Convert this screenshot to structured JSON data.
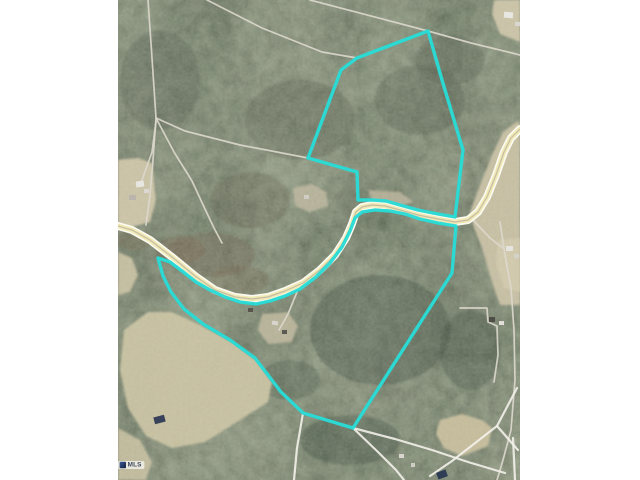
{
  "scene": {
    "width": 640,
    "height": 480,
    "background": "#ffffff"
  },
  "map": {
    "area": {
      "x": 118,
      "y": 0,
      "width": 402,
      "height": 480
    },
    "colors": {
      "forest_base": "#434a3d",
      "field_tan": "#cbc3a5",
      "road_casing": "#fbfaf0",
      "road_fill": "#f1e9b4",
      "road_centerline": "#b9b1a0",
      "parcel_line": "#ddd8cd",
      "parcel_line_bright": "#f3f1ea",
      "boundary_cyan": "#29dbd6"
    },
    "watermark": {
      "text": "MLS"
    },
    "fields": [
      {
        "name": "left-clearing",
        "color": "#cdc5a8",
        "pts": [
          [
            118,
            160
          ],
          [
            138,
            158
          ],
          [
            152,
            163
          ],
          [
            156,
            200
          ],
          [
            150,
            222
          ],
          [
            128,
            228
          ],
          [
            118,
            224
          ]
        ]
      },
      {
        "name": "left-small-field",
        "color": "#c6bfa2",
        "pts": [
          [
            118,
            252
          ],
          [
            132,
            258
          ],
          [
            138,
            275
          ],
          [
            130,
            292
          ],
          [
            118,
            295
          ]
        ]
      },
      {
        "name": "bottom-left-field",
        "color": "#c9c2a2",
        "pts": [
          [
            124,
            330
          ],
          [
            148,
            312
          ],
          [
            172,
            312
          ],
          [
            200,
            325
          ],
          [
            232,
            342
          ],
          [
            258,
            362
          ],
          [
            272,
            382
          ],
          [
            268,
            402
          ],
          [
            240,
            420
          ],
          [
            205,
            442
          ],
          [
            172,
            448
          ],
          [
            146,
            436
          ],
          [
            128,
            408
          ],
          [
            120,
            370
          ]
        ]
      },
      {
        "name": "bottom-left-strip",
        "color": "#c3bc9e",
        "pts": [
          [
            118,
            428
          ],
          [
            140,
            440
          ],
          [
            152,
            462
          ],
          [
            146,
            480
          ],
          [
            118,
            480
          ]
        ]
      },
      {
        "name": "east-road-field",
        "color": "#c8c0a4",
        "pts": [
          [
            470,
            212
          ],
          [
            480,
            185
          ],
          [
            492,
            155
          ],
          [
            503,
            132
          ],
          [
            516,
            122
          ],
          [
            520,
            122
          ],
          [
            520,
            305
          ],
          [
            500,
            305
          ],
          [
            492,
            282
          ],
          [
            482,
            248
          ],
          [
            474,
            228
          ]
        ]
      },
      {
        "name": "topright-clearing",
        "color": "#ccc4a8",
        "pts": [
          [
            494,
            0
          ],
          [
            520,
            0
          ],
          [
            520,
            42
          ],
          [
            500,
            34
          ],
          [
            492,
            14
          ]
        ]
      },
      {
        "name": "bottomright-field",
        "color": "#c7bd9c",
        "pts": [
          [
            440,
            420
          ],
          [
            462,
            414
          ],
          [
            482,
            420
          ],
          [
            492,
            428
          ],
          [
            488,
            446
          ],
          [
            462,
            456
          ],
          [
            444,
            448
          ],
          [
            436,
            434
          ]
        ]
      },
      {
        "name": "center-clearing",
        "color": "#b7b29a",
        "pts": [
          [
            293,
            188
          ],
          [
            312,
            184
          ],
          [
            326,
            192
          ],
          [
            328,
            206
          ],
          [
            310,
            212
          ],
          [
            295,
            206
          ]
        ]
      },
      {
        "name": "crest-north-clearing",
        "color": "#b3ae96",
        "pts": [
          [
            368,
            190
          ],
          [
            400,
            192
          ],
          [
            414,
            202
          ],
          [
            398,
            207
          ],
          [
            372,
            200
          ]
        ]
      },
      {
        "name": "lower-houses-clearing",
        "color": "#b9b49a",
        "pts": [
          [
            262,
            314
          ],
          [
            288,
            312
          ],
          [
            298,
            326
          ],
          [
            292,
            342
          ],
          [
            268,
            344
          ],
          [
            258,
            330
          ]
        ]
      },
      {
        "name": "east-houses-ground",
        "color": "#d0c8ab",
        "pts": [
          [
            498,
            240
          ],
          [
            520,
            238
          ],
          [
            520,
            292
          ],
          [
            504,
            288
          ],
          [
            496,
            264
          ]
        ]
      }
    ],
    "parcel_lines": [
      {
        "pts": [
          [
            148,
            0
          ],
          [
            152,
            58
          ],
          [
            156,
            118
          ]
        ]
      },
      {
        "pts": [
          [
            156,
            118
          ],
          [
            185,
            131
          ],
          [
            240,
            145
          ],
          [
            308,
            158
          ]
        ]
      },
      {
        "pts": [
          [
            156,
            118
          ],
          [
            174,
            152
          ],
          [
            192,
            181
          ],
          [
            205,
            209
          ],
          [
            214,
            228
          ],
          [
            222,
            243
          ]
        ]
      },
      {
        "pts": [
          [
            156,
            118
          ],
          [
            153,
            160
          ],
          [
            150,
            195
          ],
          [
            146,
            225
          ]
        ]
      },
      {
        "pts": [
          [
            310,
            0
          ],
          [
            428,
            31
          ],
          [
            471,
            43
          ],
          [
            520,
            55
          ]
        ]
      },
      {
        "pts": [
          [
            207,
            0
          ],
          [
            262,
            28
          ],
          [
            322,
            52
          ],
          [
            357,
            58
          ]
        ]
      },
      {
        "pts": [
          [
            500,
            222
          ],
          [
            505,
            255
          ],
          [
            511,
            288
          ],
          [
            514,
            330
          ],
          [
            515,
            380
          ],
          [
            511,
            430
          ],
          [
            503,
            460
          ],
          [
            497,
            480
          ]
        ]
      },
      {
        "pts": [
          [
            460,
            308
          ],
          [
            487,
            308
          ],
          [
            488,
            322
          ],
          [
            497,
            326
          ],
          [
            498,
            355
          ],
          [
            494,
            382
          ]
        ]
      },
      {
        "pts": [
          [
            141,
            183
          ],
          [
            152,
            152
          ],
          [
            156,
            122
          ]
        ]
      },
      {
        "pts": [
          [
            297,
            292
          ],
          [
            288,
            314
          ],
          [
            279,
            330
          ]
        ]
      },
      {
        "pts": [
          [
            472,
            219
          ],
          [
            490,
            238
          ],
          [
            503,
            248
          ]
        ]
      },
      {
        "pts": [
          [
            353,
            428
          ],
          [
            395,
            439
          ],
          [
            432,
            450
          ],
          [
            468,
            462
          ],
          [
            505,
            473
          ]
        ],
        "bright": true
      },
      {
        "pts": [
          [
            517,
            388
          ],
          [
            497,
            426
          ],
          [
            452,
            461
          ],
          [
            430,
            476
          ]
        ],
        "bright": true
      },
      {
        "pts": [
          [
            497,
            426
          ],
          [
            518,
            450
          ]
        ],
        "bright": true
      },
      {
        "pts": [
          [
            513,
            438
          ],
          [
            515,
            480
          ]
        ],
        "bright": true
      },
      {
        "pts": [
          [
            303,
            413
          ],
          [
            297,
            448
          ],
          [
            294,
            480
          ]
        ],
        "bright": true
      },
      {
        "pts": [
          [
            353,
            428
          ],
          [
            378,
            452
          ],
          [
            396,
            470
          ],
          [
            404,
            480
          ]
        ],
        "bright": true
      }
    ],
    "road": {
      "casing_width": 8,
      "fill_width": 4.6,
      "centerline_width": 1.2,
      "path": [
        [
          118,
          226
        ],
        [
          132,
          230
        ],
        [
          150,
          240
        ],
        [
          172,
          257
        ],
        [
          195,
          276
        ],
        [
          215,
          290
        ],
        [
          235,
          297
        ],
        [
          252,
          299
        ],
        [
          268,
          297
        ],
        [
          285,
          291
        ],
        [
          303,
          283
        ],
        [
          320,
          270
        ],
        [
          335,
          255
        ],
        [
          346,
          238
        ],
        [
          352,
          224
        ],
        [
          356,
          212
        ],
        [
          362,
          207
        ],
        [
          372,
          205
        ],
        [
          385,
          206
        ],
        [
          400,
          210
        ],
        [
          418,
          215
        ],
        [
          438,
          219
        ],
        [
          455,
          222
        ],
        [
          468,
          220
        ],
        [
          478,
          212
        ],
        [
          487,
          197
        ],
        [
          496,
          175
        ],
        [
          504,
          152
        ],
        [
          511,
          138
        ],
        [
          520,
          129
        ]
      ]
    },
    "houses": [
      {
        "x": 136,
        "y": 181,
        "w": 8,
        "h": 6,
        "c": "#e8e6e0",
        "r": -8
      },
      {
        "x": 129,
        "y": 195,
        "w": 7,
        "h": 5,
        "c": "#b9b5ad",
        "r": 0
      },
      {
        "x": 144,
        "y": 189,
        "w": 5,
        "h": 4,
        "c": "#dcd9d2",
        "r": 0
      },
      {
        "x": 304,
        "y": 195,
        "w": 5,
        "h": 4,
        "c": "#cfccc4",
        "r": 0
      },
      {
        "x": 272,
        "y": 321,
        "w": 6,
        "h": 4,
        "c": "#d8d5cc",
        "r": 10
      },
      {
        "x": 282,
        "y": 330,
        "w": 5,
        "h": 4,
        "c": "#5a5a52",
        "r": 0
      },
      {
        "x": 504,
        "y": 12,
        "w": 9,
        "h": 6,
        "c": "#e9e7e1",
        "r": 5
      },
      {
        "x": 515,
        "y": 22,
        "w": 5,
        "h": 4,
        "c": "#dad7d0",
        "r": 0
      },
      {
        "x": 506,
        "y": 246,
        "w": 7,
        "h": 5,
        "c": "#e6e4de",
        "r": 0
      },
      {
        "x": 514,
        "y": 254,
        "w": 5,
        "h": 4,
        "c": "#d5d2ca",
        "r": 0
      },
      {
        "x": 489,
        "y": 317,
        "w": 6,
        "h": 5,
        "c": "#4e4e46",
        "r": 0
      },
      {
        "x": 499,
        "y": 321,
        "w": 5,
        "h": 4,
        "c": "#e2dfd8",
        "r": 0
      },
      {
        "x": 399,
        "y": 454,
        "w": 5,
        "h": 4,
        "c": "#d9d6ce",
        "r": 0
      },
      {
        "x": 411,
        "y": 463,
        "w": 4,
        "h": 4,
        "c": "#cfccc5",
        "r": 0
      },
      {
        "x": 248,
        "y": 308,
        "w": 5,
        "h": 4,
        "c": "#57554c",
        "r": 0
      },
      {
        "x": 437,
        "y": 471,
        "w": 10,
        "h": 7,
        "c": "#2e3d55",
        "r": -20
      },
      {
        "x": 154,
        "y": 416,
        "w": 11,
        "h": 7,
        "c": "#37425a",
        "r": -15
      }
    ],
    "boundary": {
      "color": "#29dbd6",
      "width": 3.4,
      "parcels": [
        {
          "name": "upper-parcel",
          "pts": [
            [
              428,
              31
            ],
            [
              357,
              58
            ],
            [
              341,
              70
            ],
            [
              308,
              158
            ],
            [
              357,
              172
            ],
            [
              358,
              200
            ],
            [
              372,
              200
            ],
            [
              386,
              201
            ],
            [
              400,
              205
            ],
            [
              418,
              210
            ],
            [
              438,
              214
            ],
            [
              455,
              217
            ],
            [
              463,
              150
            ],
            [
              442,
              80
            ]
          ]
        },
        {
          "name": "lower-parcel",
          "pts": [
            [
              158,
              258
            ],
            [
              170,
              262
            ],
            [
              182,
              271
            ],
            [
              196,
              282
            ],
            [
              210,
              290
            ],
            [
              225,
              297
            ],
            [
              240,
              302
            ],
            [
              256,
              304
            ],
            [
              270,
              301
            ],
            [
              285,
              296
            ],
            [
              300,
              289
            ],
            [
              316,
              277
            ],
            [
              330,
              263
            ],
            [
              342,
              247
            ],
            [
              350,
              231
            ],
            [
              355,
              218
            ],
            [
              362,
              212
            ],
            [
              375,
              210
            ],
            [
              390,
              211
            ],
            [
              405,
              214
            ],
            [
              420,
              219
            ],
            [
              438,
              223
            ],
            [
              456,
              226
            ],
            [
              452,
              273
            ],
            [
              353,
              428
            ],
            [
              303,
              413
            ],
            [
              281,
              392
            ],
            [
              255,
              358
            ],
            [
              230,
              340
            ],
            [
              203,
              324
            ],
            [
              184,
              309
            ],
            [
              171,
              292
            ],
            [
              163,
              276
            ]
          ]
        }
      ]
    }
  }
}
